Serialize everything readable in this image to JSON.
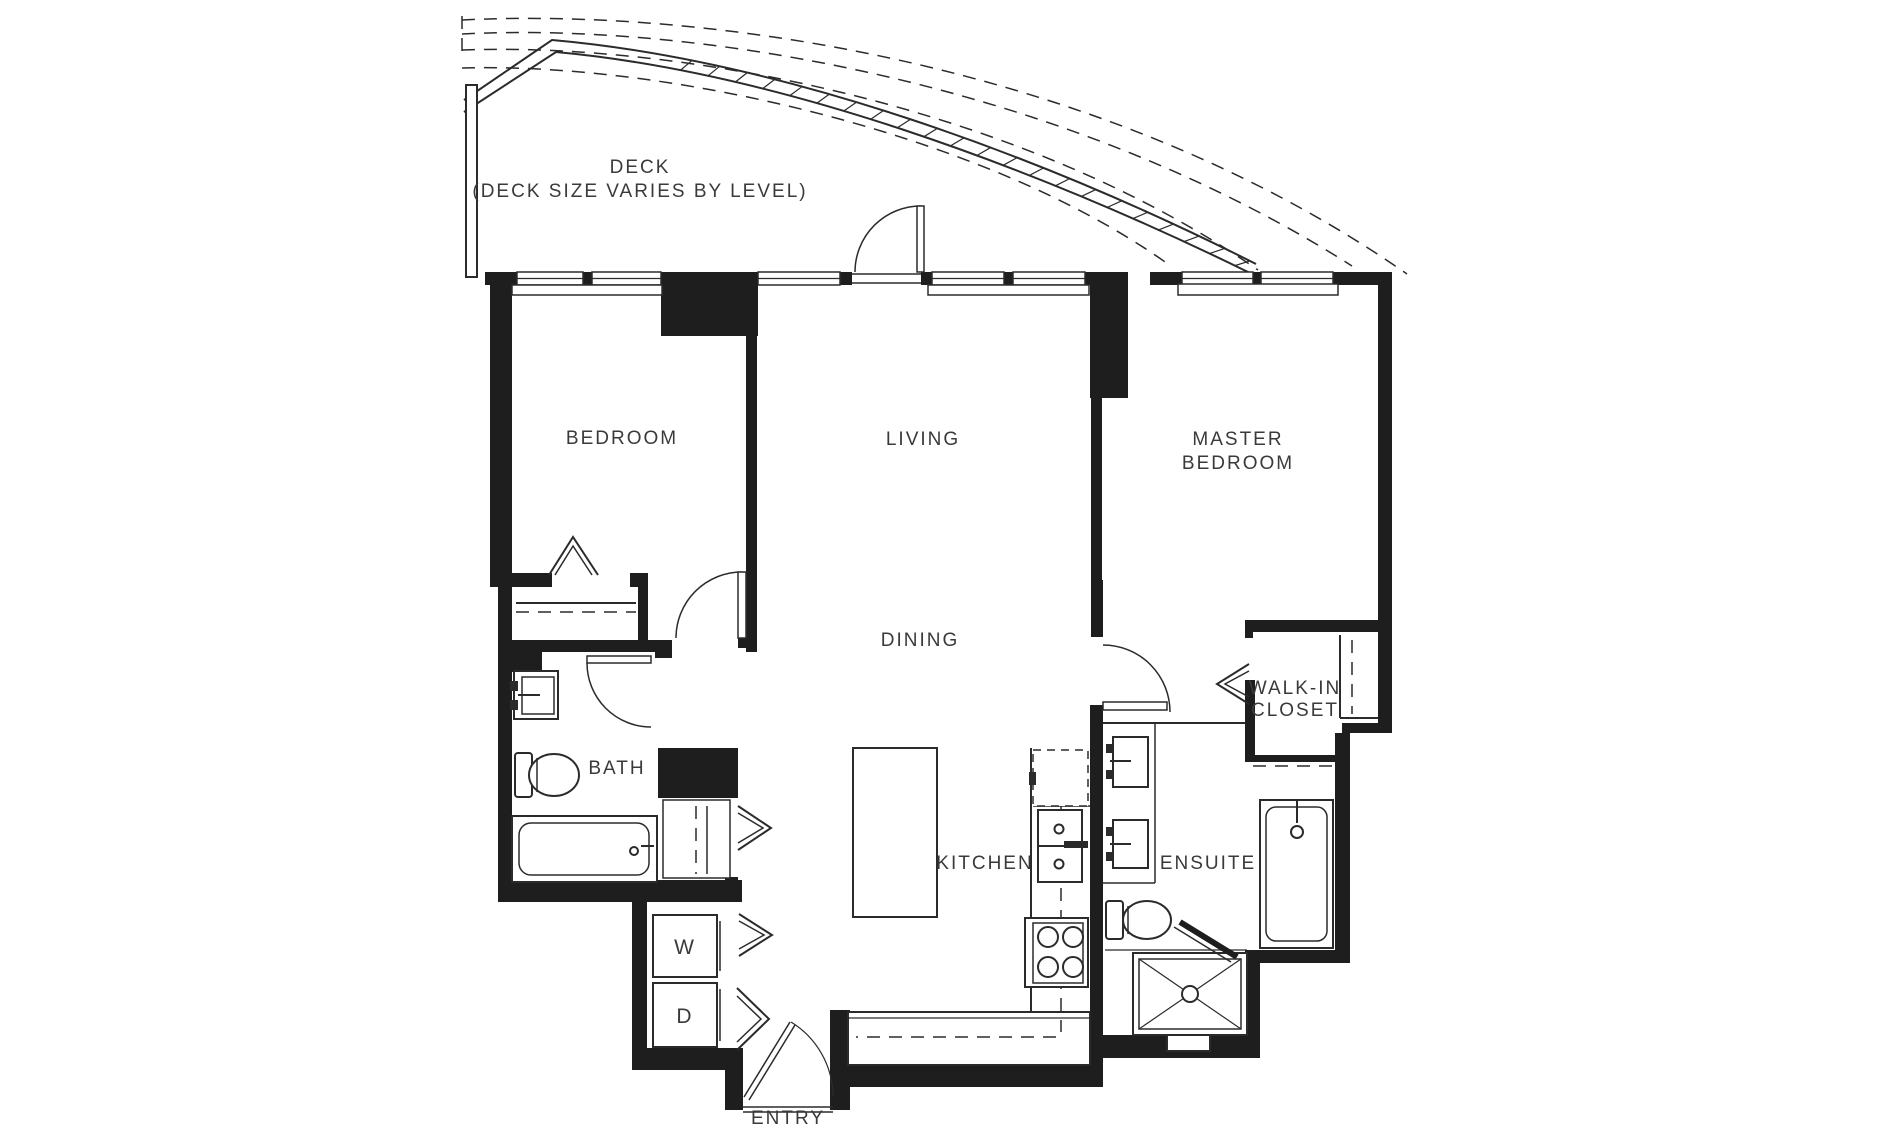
{
  "plan": {
    "type": "residential-floor-plan",
    "colors": {
      "wall": "#1e1e1e",
      "line": "#2b2b2b",
      "text": "#3a3a3a",
      "background": "#ffffff"
    },
    "rooms": {
      "deck": {
        "label": "DECK",
        "note": "(DECK SIZE VARIES BY LEVEL)"
      },
      "bedroom": {
        "label": "BEDROOM"
      },
      "living": {
        "label": "LIVING"
      },
      "master": {
        "line1": "MASTER",
        "line2": "BEDROOM"
      },
      "dining": {
        "label": "DINING"
      },
      "bath": {
        "label": "BATH"
      },
      "kitchen": {
        "label": "KITCHEN"
      },
      "ensuite": {
        "label": "ENSUITE"
      },
      "walkin": {
        "line1": "WALK-IN",
        "line2": "CLOSET"
      },
      "entry": {
        "label": "ENTRY"
      },
      "laundry": {
        "washer": "W",
        "dryer": "D"
      }
    },
    "fixtures": [
      "bath-vanity-sink",
      "bath-toilet",
      "bath-bathtub",
      "kitchen-island",
      "refrigerator",
      "kitchen-double-sink",
      "stove-cooktop",
      "kitchen-counter",
      "ensuite-vanity-sink-1",
      "ensuite-vanity-sink-2",
      "ensuite-toilet",
      "shower-stall",
      "ensuite-bathtub",
      "washer-box",
      "dryer-box",
      "bedroom-closet-rod",
      "linen-closet",
      "walk-in-wardrobe"
    ],
    "symbols": [
      "deck-outline-dashed-arcs",
      "deck-railing",
      "window-band",
      "window-sill",
      "swing-door-arc",
      "bifold-chevron-door",
      "closet-hanger-symbol"
    ]
  }
}
